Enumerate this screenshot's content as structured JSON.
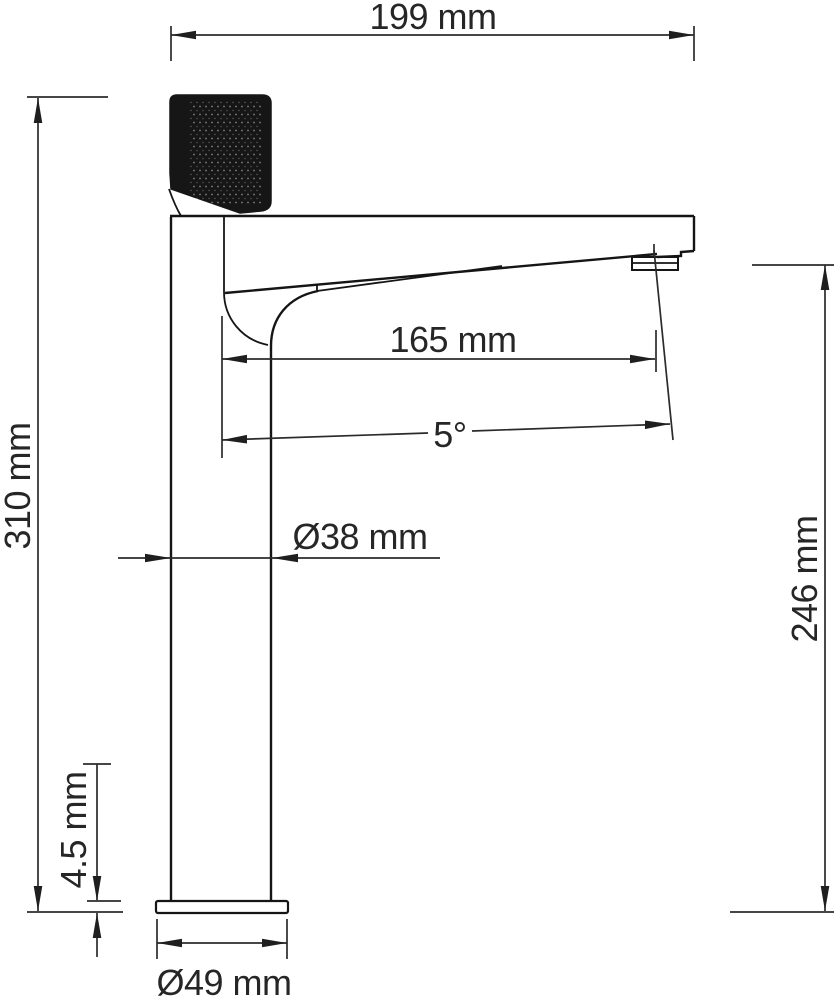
{
  "drawing": {
    "colors": {
      "background": "#ffffff",
      "outline": "#151515",
      "dimension": "#2b2b2b",
      "handle_fill": "#161616"
    },
    "dimensions": {
      "total_width": {
        "label": "199 mm",
        "value": 199,
        "unit": "mm"
      },
      "total_height": {
        "label": "310 mm",
        "value": 310,
        "unit": "mm"
      },
      "spout_reach": {
        "label": "165 mm",
        "value": 165,
        "unit": "mm"
      },
      "spout_angle": {
        "label": "5°",
        "value": 5,
        "unit": "deg"
      },
      "body_diameter": {
        "label": "Ø38 mm",
        "value": 38,
        "unit": "mm"
      },
      "outlet_height": {
        "label": "246 mm",
        "value": 246,
        "unit": "mm"
      },
      "base_thickness": {
        "label": "4.5 mm",
        "value": 4.5,
        "unit": "mm"
      },
      "base_diameter": {
        "label": "Ø49 mm",
        "value": 49,
        "unit": "mm"
      }
    }
  }
}
